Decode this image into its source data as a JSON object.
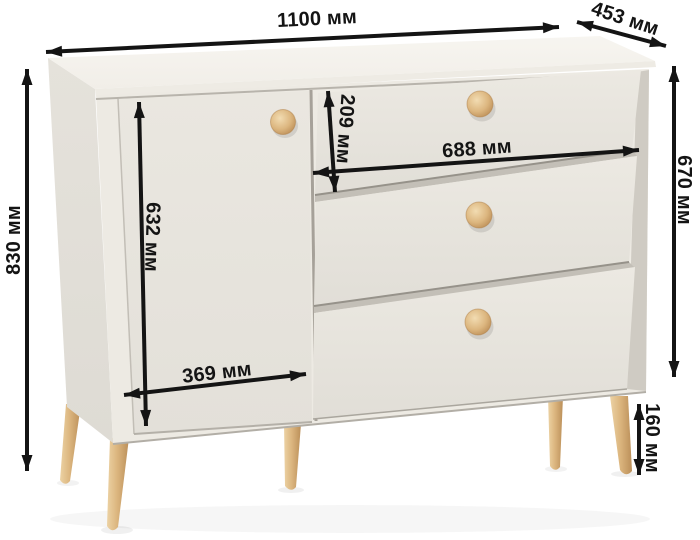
{
  "meta": {
    "kind": "furniture-dimension-diagram",
    "unit": "мм"
  },
  "colors": {
    "background": "#ffffff",
    "top_surface": "#f7f5f0",
    "top_edge": "#eeebe4",
    "side_panel": "#e5e2db",
    "front_face": "#edeae3",
    "door_face": "#eae7e0",
    "drawer_face": "#eae7e0",
    "recess_shadow": "#cfcbc3",
    "gap_shadow": "#c3bfb7",
    "gap_line": "#96928a",
    "wood_light": "#ecd2a4",
    "wood_mid": "#dcb67f",
    "wood_dark": "#bb8f59",
    "dimension": "#141414"
  },
  "furniture": {
    "drawer_count": 3,
    "door_count": 1,
    "knob_count": 4,
    "visible_leg_count": 5
  },
  "dimensions": {
    "width": {
      "label": "1100 мм",
      "value": 1100,
      "unit": "мм"
    },
    "depth": {
      "label": "453 мм",
      "value": 453,
      "unit": "мм"
    },
    "height_total": {
      "label": "830 мм",
      "value": 830,
      "unit": "мм"
    },
    "body_height": {
      "label": "670 мм",
      "value": 670,
      "unit": "мм"
    },
    "top_drawer_height": {
      "label": "209 мм",
      "value": 209,
      "unit": "мм"
    },
    "drawer_width": {
      "label": "688 мм",
      "value": 688,
      "unit": "мм"
    },
    "door_height": {
      "label": "632 мм",
      "value": 632,
      "unit": "мм"
    },
    "door_width": {
      "label": "369 мм",
      "value": 369,
      "unit": "мм"
    },
    "leg_height": {
      "label": "160 мм",
      "value": 160,
      "unit": "мм"
    }
  }
}
